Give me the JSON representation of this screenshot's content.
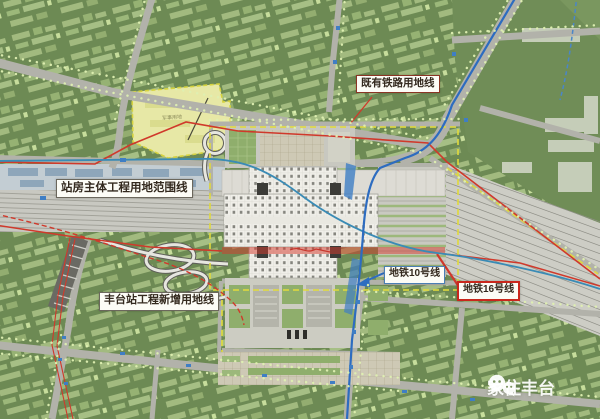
{
  "labels": {
    "station_main": "站房主体工程用地范围线",
    "existing_railway": "既有铁路用地线",
    "fengtai_new": "丰台站工程新增用地线",
    "metro_line_10": "地铁10号线",
    "metro_line_16": "地铁16号线",
    "military_parcel": "军事用地"
  },
  "watermark": {
    "text": "家住丰台",
    "icon": "wechat-icon"
  },
  "colors": {
    "ground_green": "#6d8a54",
    "block_green": "#a2ba7f",
    "tree_dot": "#dff0b2",
    "road_gray": "#b2b2aa",
    "rail_gray": "#c8c8c1",
    "station_white": "#f0efe9",
    "boundary_red": "#d0392b",
    "metro_blue": "#2d6cc0",
    "metro_teal": "#3a8bb5",
    "parcel_yellow": "#e7e8a6",
    "dashed_yellow": "#e0da3e"
  }
}
